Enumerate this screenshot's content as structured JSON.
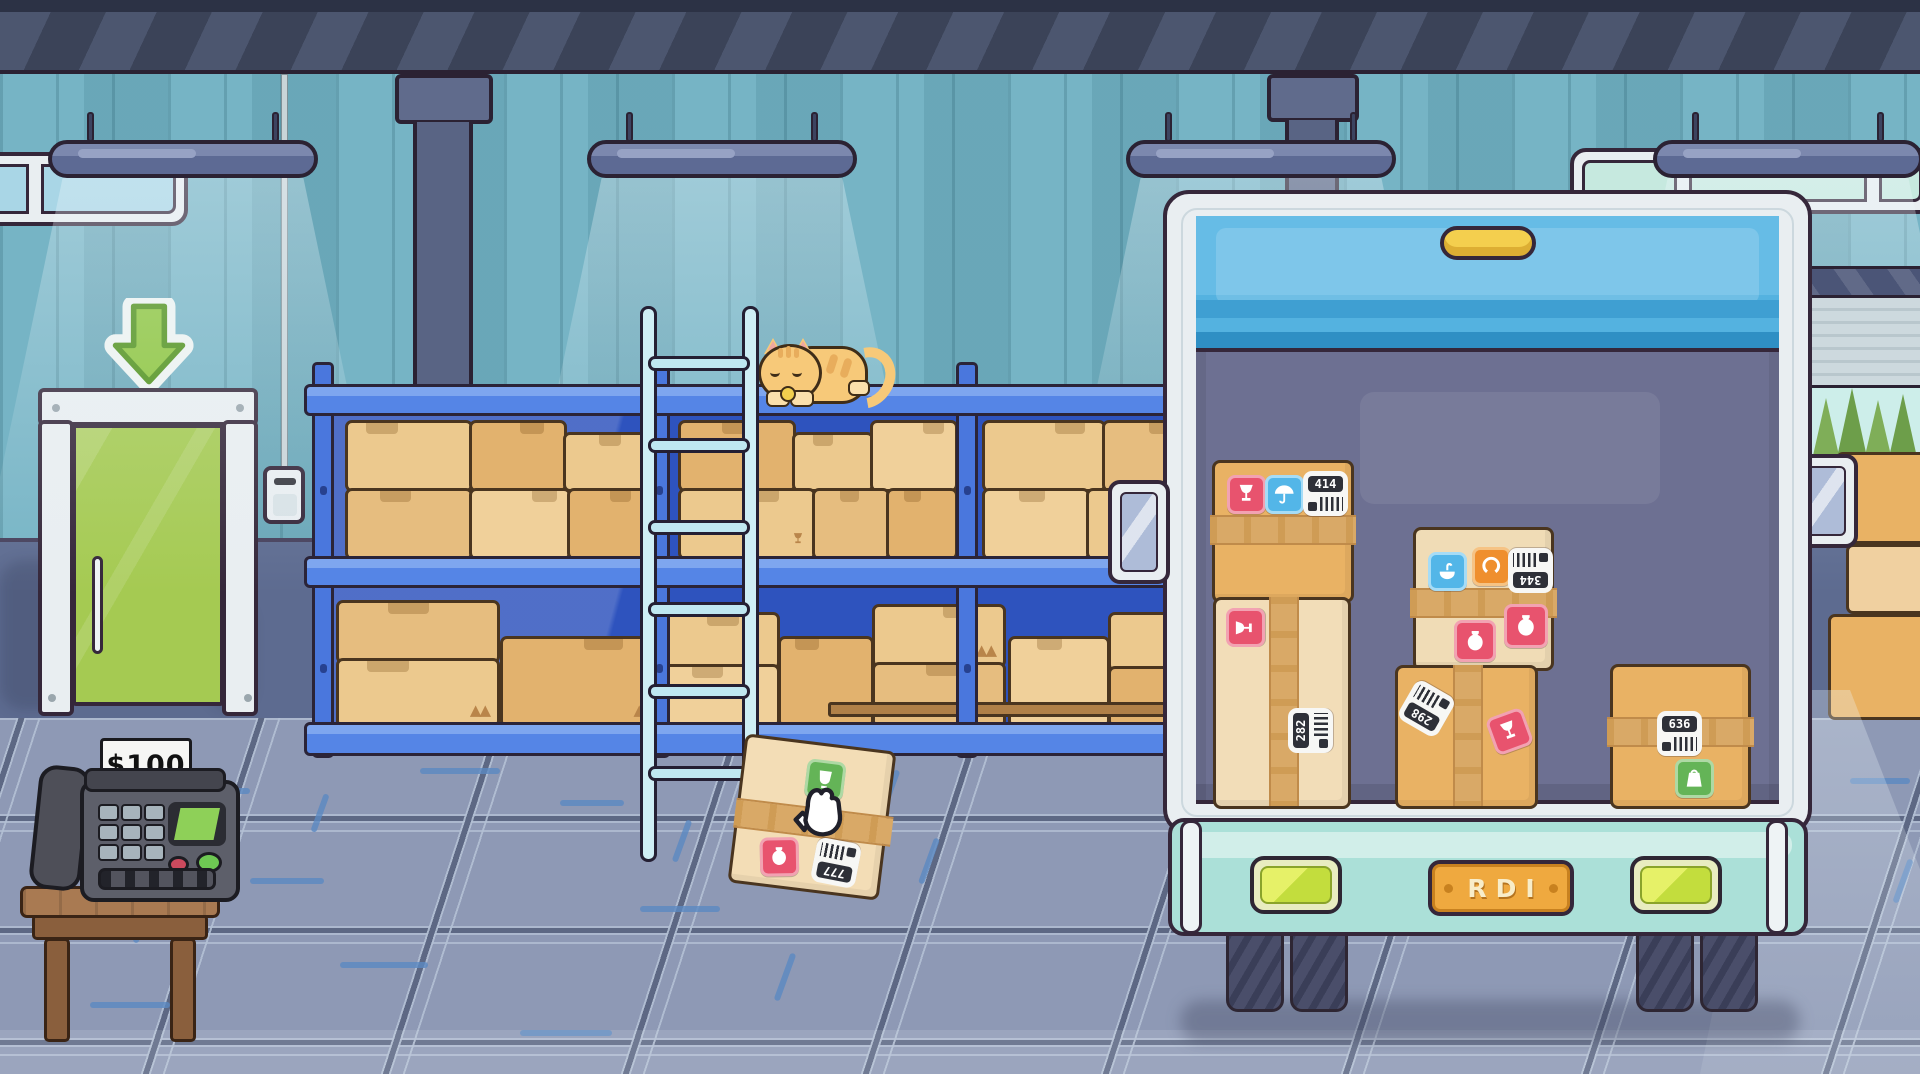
{
  "register": {
    "price_sign": "$100"
  },
  "truck": {
    "license_plate": "RDI",
    "boxes": [
      {
        "id": "truck-box-top-left",
        "label_number": "414",
        "stickers": [
          "fragile",
          "umbrella",
          "barcode-label"
        ]
      },
      {
        "id": "truck-box-tall-left",
        "label_number": "282",
        "stickers": [
          "fragile",
          "barcode-label"
        ]
      },
      {
        "id": "truck-box-middle-upper",
        "label_number": "344",
        "stickers": [
          "sink",
          "claw",
          "barcode-label",
          "vase",
          "vase"
        ]
      },
      {
        "id": "truck-box-middle-lower",
        "label_number": "298",
        "stickers": [
          "barcode-label",
          "fragile"
        ]
      },
      {
        "id": "truck-box-right",
        "label_number": "636",
        "stickers": [
          "barcode-label",
          "weight"
        ]
      }
    ]
  },
  "floor_box": {
    "label_number": "777",
    "stickers": [
      "cup",
      "vase",
      "barcode-label"
    ],
    "cursor": "grab-hand"
  },
  "icons": {
    "fragile": "wine-glass-icon",
    "umbrella": "umbrella-icon",
    "sink": "washbasin-icon",
    "claw": "claw-icon",
    "vase": "vase-icon",
    "weight": "weight-icon",
    "cup": "cup-icon",
    "barcode": "barcode-label",
    "door_sign": "down-arrow-icon",
    "cursor": "grab-hand-icon",
    "cat": "sleeping-cat"
  },
  "colors": {
    "wall": "#6fb0c2",
    "wainscot": "#5d6b90",
    "floor": "#8e99b5",
    "shelf_blue": "#4a77dd",
    "shelf_interior": "#2e53be",
    "ladder": "#cfeef5",
    "box_tan": "#e9b264",
    "box_cream": "#f2ddb8",
    "truck_frame": "#e9eef1",
    "truck_door": "#54b2e0",
    "truck_interior": "#6d7092",
    "bumper_mint": "#abe0d8",
    "tail_light": "#c3dd3d",
    "plate_orange": "#efa93f",
    "handle_yellow": "#f4cf4e",
    "door_green": "#a5ca52",
    "sticker_red": "#e8536e",
    "sticker_blue": "#53b6e8",
    "sticker_orange": "#ef8f2e",
    "sticker_green": "#64b457"
  }
}
